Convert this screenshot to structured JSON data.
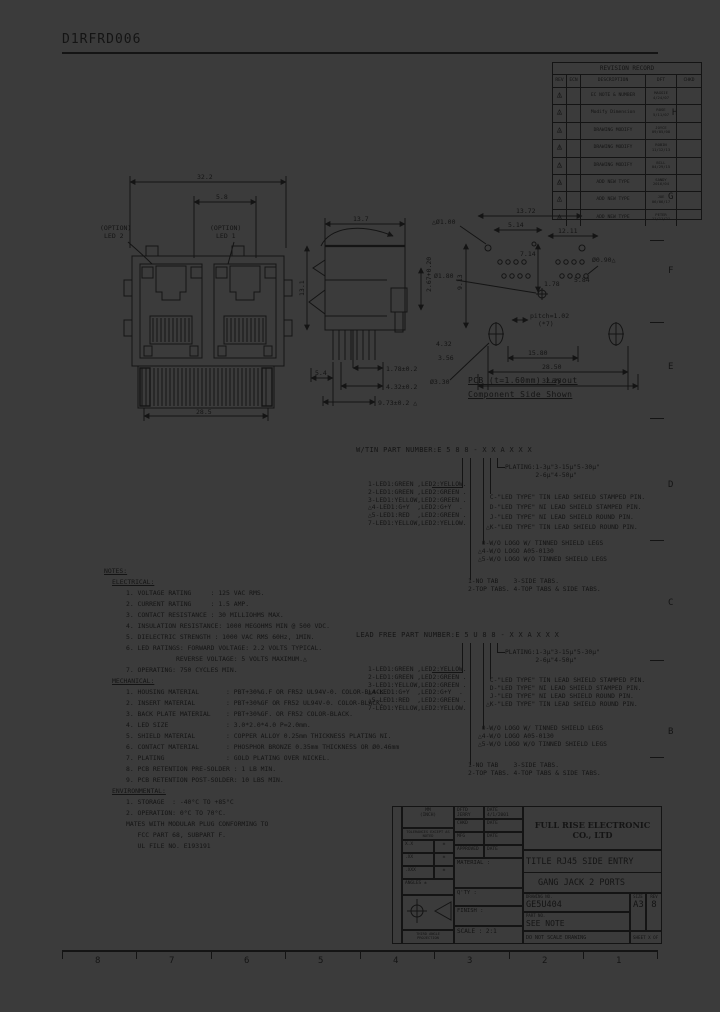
{
  "page": {
    "doc_number": "D1RFRD006",
    "ink_color": "#141414",
    "paper_color": "#3b3b3b",
    "zone_letters_right": [
      "H",
      "G",
      "F",
      "E",
      "D",
      "C",
      "B"
    ],
    "zone_numbers_bottom": [
      "8",
      "7",
      "6",
      "5",
      "4",
      "3",
      "2",
      "1"
    ]
  },
  "revision_table": {
    "title": "REVISION RECORD",
    "columns": [
      "REV",
      "ECN",
      "DESCRIPTION",
      "DFT",
      "CHKD"
    ],
    "rows": [
      {
        "rev": "1",
        "ecn": "",
        "description": "EC NOTE & NUMBER",
        "dft": "MAGGIE\n4/24/07",
        "chkd": ""
      },
      {
        "rev": "2",
        "ecn": "",
        "description": "Modify Dimension",
        "dft": "ROSE\n5/11/07",
        "chkd": ""
      },
      {
        "rev": "3",
        "ecn": "",
        "description": "DRAWING MODIFY",
        "dft": "JOYCE\n09/05/08",
        "chkd": ""
      },
      {
        "rev": "4",
        "ecn": "",
        "description": "DRAWING MODIFY",
        "dft": "ROBIN\n11/12/13",
        "chkd": ""
      },
      {
        "rev": "5",
        "ecn": "",
        "description": "DRAWING MODIFY",
        "dft": "BILL\n04/29/15",
        "chkd": ""
      },
      {
        "rev": "6",
        "ecn": "",
        "description": "ADD NEW TYPE",
        "dft": "SANDY\n2016/04",
        "chkd": ""
      },
      {
        "rev": "7",
        "ecn": "",
        "description": "ADD NEW TYPE",
        "dft": "JOE\n06/06/17",
        "chkd": ""
      },
      {
        "rev": "8",
        "ecn": "",
        "description": "ADD NEW TYPE",
        "dft": "PETER\n11/11/21",
        "chkd": ""
      }
    ]
  },
  "front_view": {
    "dim_width": "32.2",
    "dim_led": "5.8",
    "dim_bottom": "28.5",
    "label_led2_l1": "(OPTION)",
    "label_led2_l2": "LED 2",
    "label_led1_l1": "(OPTION)",
    "label_led1_l2": "LED 1"
  },
  "side_view": {
    "dim_top": "13.7",
    "dim_left": "13.1",
    "dim_right": "2.67+0.20",
    "dim_b1": "5.4",
    "dim_b2": "1.78±0.2",
    "dim_b3": "4.32±0.2",
    "dim_b4": "9.73±0.2 △"
  },
  "pcb_layout": {
    "d_13_72": "13.72",
    "d_5_14": "5.14",
    "d_12_11": "12.11",
    "d_hole1": "△Ø1.00",
    "d_7_14": "7.14",
    "d_1_78": "1.78",
    "d_hole2": "Ø1.80",
    "d_9_13": "9.13",
    "d_hole3": "Ø0.90△",
    "d_5_84": "5.84",
    "d_4_32": "4.32",
    "d_3_56": "3.56",
    "d_hole4": "Ø3.30",
    "d_15_80": "15.80",
    "d_28_50": "28.50",
    "d_32_25": "32.25",
    "pitch_l1": "pitch=1.02",
    "pitch_l2": "(*7)",
    "caption1": "PCB (t=1.60mm) Layout",
    "caption2": "Component Side Shown"
  },
  "part_number_tin": {
    "header": "W/TIN PART NUMBER:E 5 8 8 - X X A X X X"
  },
  "part_number_leadfree": {
    "header": "LEAD FREE PART NUMBER:E 5 U 8 8 - X X A X X X"
  },
  "part_number_options": {
    "led_colors": [
      "1-LED1:GREEN ,LED2:YELLOW.",
      "2-LED1:GREEN ,LED2:GREEN .",
      "3-LED1:YELLOW,LED2:GREEN .",
      "△4-LED1:G+Y  ,LED2:G+Y  .",
      "△5-LED1:RED  ,LED2:GREEN .",
      "7-LED1:YELLOW,LED2:YELLOW."
    ],
    "plating": [
      "PLATING:1-3μ\"3-15μ\"5-30μ\"",
      "        2-6μ\"4-50μ\""
    ],
    "led_type": [
      " C-\"LED TYPE\" TIN LEAD SHIELD STAMPED PIN.",
      " D-\"LED TYPE\" NI LEAD SHIELD STAMPED PIN.",
      " J-\"LED TYPE\" NI LEAD SHIELD ROUND PIN.",
      "△K-\"LED TYPE\" TIN LEAD SHIELD ROUND PIN."
    ],
    "logo": [
      " 0-W/O LOGO W/ TINNED SHIELD LEGS",
      "△4-W/O LOGO A05-0130",
      "△5-W/O LOGO W/O TINNED SHIELD LEGS"
    ],
    "tabs": [
      "1-NO TAB    3-SIDE TABS.",
      "2-TOP TABS. 4-TOP TABS & SIDE TABS."
    ]
  },
  "notes": {
    "title": "NOTES:",
    "electrical_title": "ELECTRICAL:",
    "electrical": [
      "1. VOLTAGE RATING     : 125 VAC RMS.",
      "2. CURRENT RATING     : 1.5 AMP.",
      "3. CONTACT RESISTANCE : 30 MILLIOHMS MAX.",
      "4. INSULATION RESISTANCE: 1000 MEGOHMS MIN @ 500 VDC.",
      "5. DIELECTRIC STRENGTH : 1000 VAC RMS 60Hz, 1MIN.",
      "6. LED RATINGS: FORWARD VOLTAGE: 2.2 VOLTS TYPICAL.",
      "             REVERSE VOLTAGE: 5 VOLTS MAXIMUM.△",
      "7. OPERATING: 750 CYCLES MIN."
    ],
    "mechanical_title": "MECHANICAL:",
    "mechanical": [
      "1. HOUSING MATERIAL       : PBT+30%G.F OR FR52 UL94V-0. COLOR-BLACK.",
      "2. INSERT MATERIAL        : PBT+30%GF OR FR52 UL94V-0. COLOR-BLACK.",
      "3. BACK PLATE MATERIAL    : PBT+30%GF. OR FR52 COLOR-BLACK.",
      "4. LED SIZE               : 3.0*2.0*4.0 P=2.0mm.",
      "5. SHIELD MATERIAL        : COPPER ALLOY 0.25mm THICKNESS PLATING NI.",
      "6. CONTACT MATERIAL       : PHOSPHOR BRONZE 0.35mm THICKNESS OR Ø0.46mm",
      "7. PLATING                : GOLD PLATING OVER NICKEL.",
      "8. PCB RETENTION PRE-SOLDER : 1 LB MIN.",
      "9. PCB RETENTION POST-SOLDER: 10 LBS MIN."
    ],
    "environmental_title": "ENVIRONMENTAL:",
    "environmental": [
      "1. STORAGE  : -40°C TO +85°C",
      "2. OPERATION: 0°C TO 70°C.",
      "MATES WITH MODULAR PLUG CONFORMING TO",
      "   FCC PART 68, SUBPART F.",
      "   UL FILE NO. E193191"
    ]
  },
  "title_block": {
    "company": "FULL RISE ELECTRONIC CO., LTD",
    "title_l1": "TITLE RJ45 SIDE ENTRY LEAD",
    "title_l2": "GANG JACK 2 PORTS",
    "drawing_no_label": "DRAWING NO.",
    "drawing_no": "GE5U404",
    "part_no_label": "PART NO.",
    "part_no": "SEE NOTE",
    "size_label": "SIZE",
    "size": "A3",
    "rev_label": "REV",
    "rev": "8",
    "scale": "SCALE : 2:1",
    "do_not_scale": "DO NOT SCALE DRAWING",
    "sheet": "SHEET X  OF Y",
    "material_label": "MATERIAL :",
    "qty_label": "Q'TY :",
    "finish_label": "FINISH :",
    "dftd": "DFTD JERRY",
    "dftd_date": "DATE 4/1/2001",
    "chkd": "CHKD",
    "chkd_date": "DATE",
    "mfg": "MFG",
    "mfg_date": "DATE",
    "appr": "APPROVED",
    "appr_date": "DATE",
    "mm": "MM",
    "inch": "(INCH)",
    "tol_note": "TOLERANCES EXCEPT AS NOTED",
    "tol_r1c1": "X.X",
    "tol_r1c2": "±",
    "tol_r2c1": ".XX",
    "tol_r2c2": "±",
    "tol_r3c1": ".XXX",
    "tol_r3c2": "±",
    "angles": "ANGLES ±",
    "third_angle": "THIRD ANGLE PROJECTION",
    "side_label": "DETACHED NOTE"
  }
}
